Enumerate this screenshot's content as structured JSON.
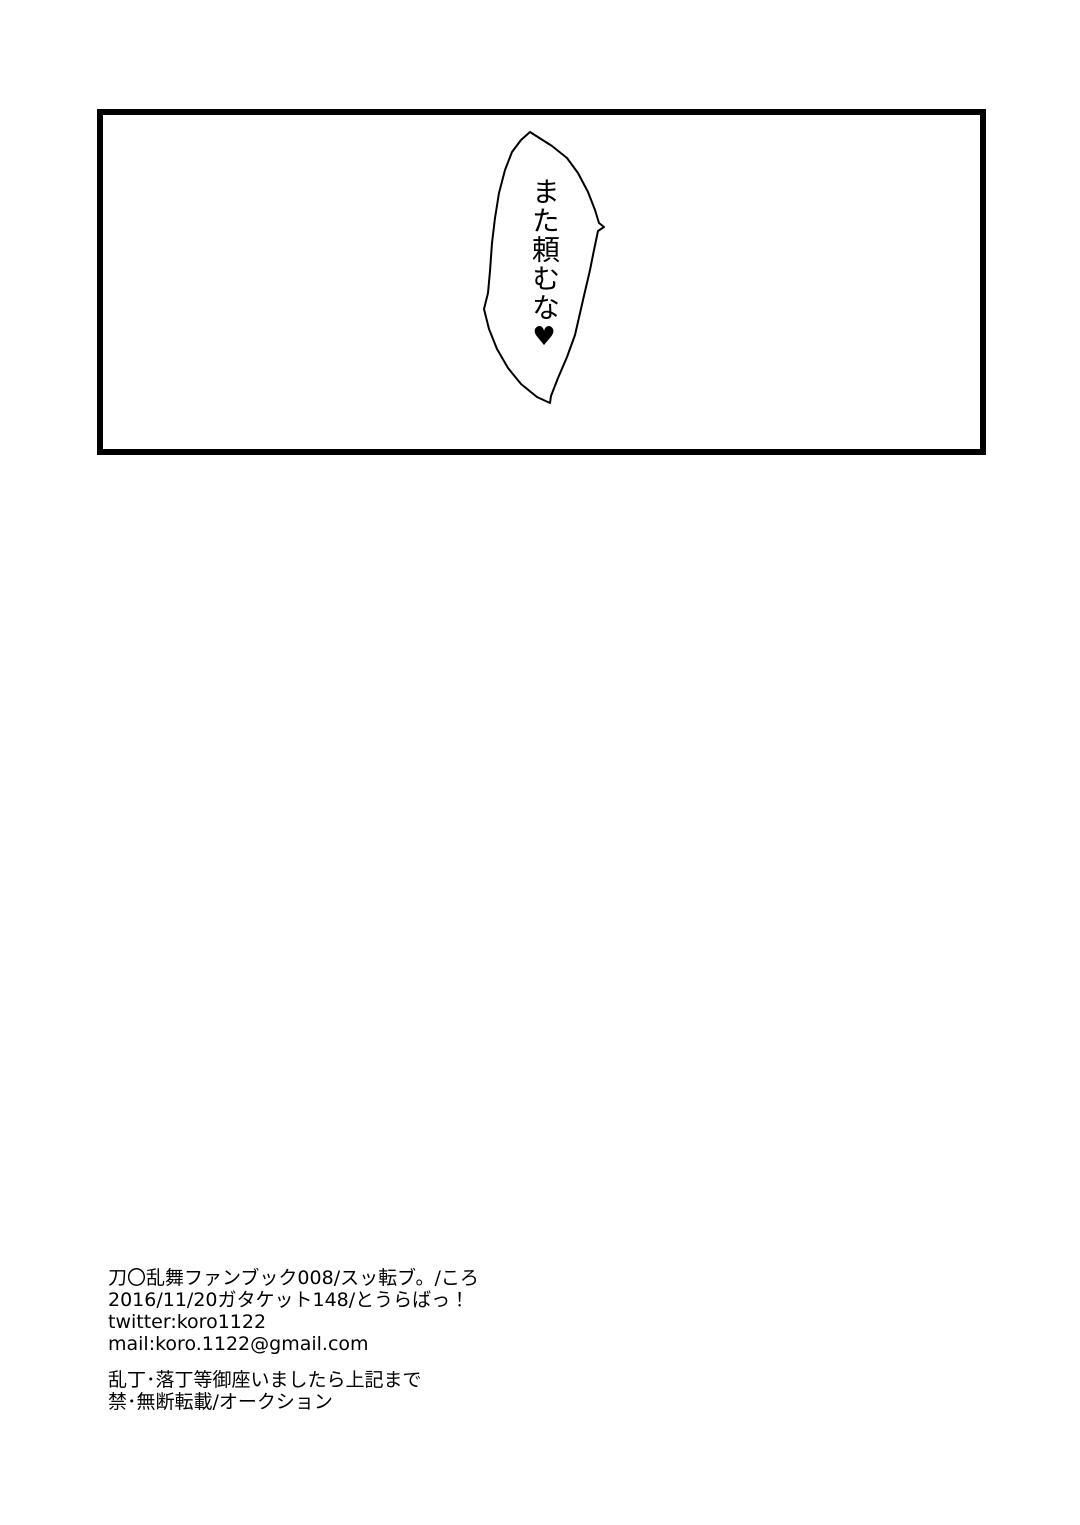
{
  "canvas": {
    "background": "#ffffff",
    "ink": "#000000"
  },
  "panel": {
    "speech_bubble": {
      "text": "また頼むな",
      "heart": "♥"
    }
  },
  "colophon": {
    "publication_lines": [
      "刀〇乱舞ファンブック008/スッ転ブ。/ころ",
      "2016/11/20ガタケット148/とうらばっ！",
      "twitter:koro1122",
      "mail:koro.1122@gmail.com"
    ],
    "notice_lines": [
      "乱丁･落丁等御座いましたら上記まで",
      "禁･無断転載/オークション"
    ]
  }
}
